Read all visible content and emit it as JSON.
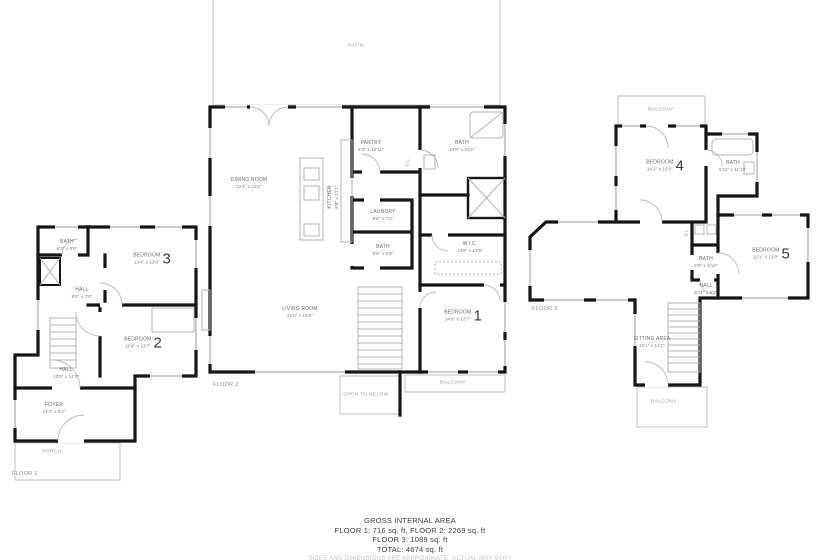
{
  "footer": {
    "title": "GROSS INTERNAL AREA",
    "line1": "FLOOR 1: 716 sq. ft, FLOOR 2: 2269 sq. ft",
    "line2": "FLOOR 3: 1089 sq. ft",
    "line3": "TOTAL: 4674 sq. ft",
    "disclaimer": "SIZES AND DIMENSIONS ARE APPROXIMATE, ACTUAL MAY VARY"
  },
  "floor1": {
    "tag": "FLOOR 1",
    "rooms": {
      "bath": {
        "label": "BATH",
        "dims": "6'3\" x 8'5\""
      },
      "bedroom3": {
        "label": "BEDROOM",
        "number": "3",
        "dims": "13'4\" x 13'0\""
      },
      "hall_upper": {
        "label": "HALL",
        "dims": "8'5\" x 7'0\""
      },
      "bedroom2": {
        "label": "BEDROOM",
        "number": "2",
        "dims": "12'4\" x 13'7\""
      },
      "hall": {
        "label": "HALL",
        "dims": "13'9\" x 14'2\""
      },
      "foyer": {
        "label": "FOYER",
        "dims": "13'4\" x 9'2\""
      },
      "porch": {
        "label": "PORCH"
      }
    }
  },
  "floor2": {
    "tag": "FLOOR 2",
    "rooms": {
      "patio": {
        "label": "PATIO"
      },
      "dining": {
        "label": "DINING ROOM",
        "dims": "12'4\" x 16'1\""
      },
      "kitchen": {
        "label": "KITCHEN",
        "dims": "8'8\" x 21'1\""
      },
      "pantry": {
        "label": "PANTRY",
        "dims": "5'3\" x 10'11\""
      },
      "bath_top": {
        "label": "BATH",
        "dims": "13'8\" x 16'1\""
      },
      "closet": {
        "label": "CL."
      },
      "laundry": {
        "label": "LAUNDRY",
        "dims": "9'6\" x 7'2\""
      },
      "bath_small": {
        "label": "BATH",
        "dims": "9'8\" x 5'8\""
      },
      "wic": {
        "label": "W.I.C.",
        "dims": "13'8\" x 13'5\""
      },
      "bedroom1": {
        "label": "BEDROOM",
        "number": "1",
        "dims": "14'6\" x 13'7\""
      },
      "living": {
        "label": "LIVING ROOM",
        "dims": "21'8\" x 19'9\""
      },
      "open_below": {
        "label": "OPEN TO BELOW"
      },
      "balcony": {
        "label": "BALCONY"
      }
    }
  },
  "floor3": {
    "tag": "FLOOR 3",
    "rooms": {
      "balcony_top": {
        "label": "BALCONY"
      },
      "bedroom4": {
        "label": "BEDROOM",
        "number": "4",
        "dims": "14'2\" x 16'0\""
      },
      "bath_upper": {
        "label": "BATH",
        "dims": "5'11\" x 11'10\""
      },
      "closet": {
        "label": "CL."
      },
      "bedroom5": {
        "label": "BEDROOM",
        "number": "5",
        "dims": "12'1\" x 13'0\""
      },
      "bath": {
        "label": "BATH",
        "dims": "8'0\" x 5'10\""
      },
      "hall": {
        "label": "HALL",
        "dims": "8'11\" x 8'2\""
      },
      "sitting": {
        "label": "SITTING AREA",
        "dims": "15'1\" x 14'1\""
      },
      "balcony_bottom": {
        "label": "BALCONY"
      }
    }
  }
}
